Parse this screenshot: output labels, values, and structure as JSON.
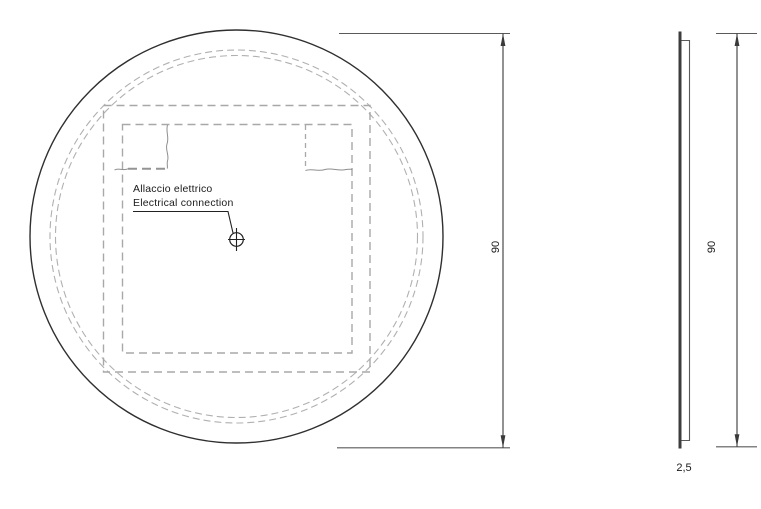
{
  "drawing_title": "Round mirror technical drawing",
  "colors": {
    "background": "#ffffff",
    "outline": "#2f2f2f",
    "dashed": "#a8a8a8",
    "dashed_light": "#b0b0b0",
    "dashed_heavy": "#949494",
    "break_line": "#8f8f8f",
    "dimension": "#3a3a3a",
    "extension": "#5a5a5a",
    "leader": "#222222",
    "text": "#1a1a1a",
    "side_glass": "#3d3d3d",
    "side_backing": "#5a5a5a"
  },
  "front_view": {
    "callout_line1": "Allaccio elettrico",
    "callout_line2": "Electrical connection",
    "height_dimension": "90"
  },
  "side_view": {
    "height_dimension": "90",
    "thickness_dimension": "2,5"
  }
}
